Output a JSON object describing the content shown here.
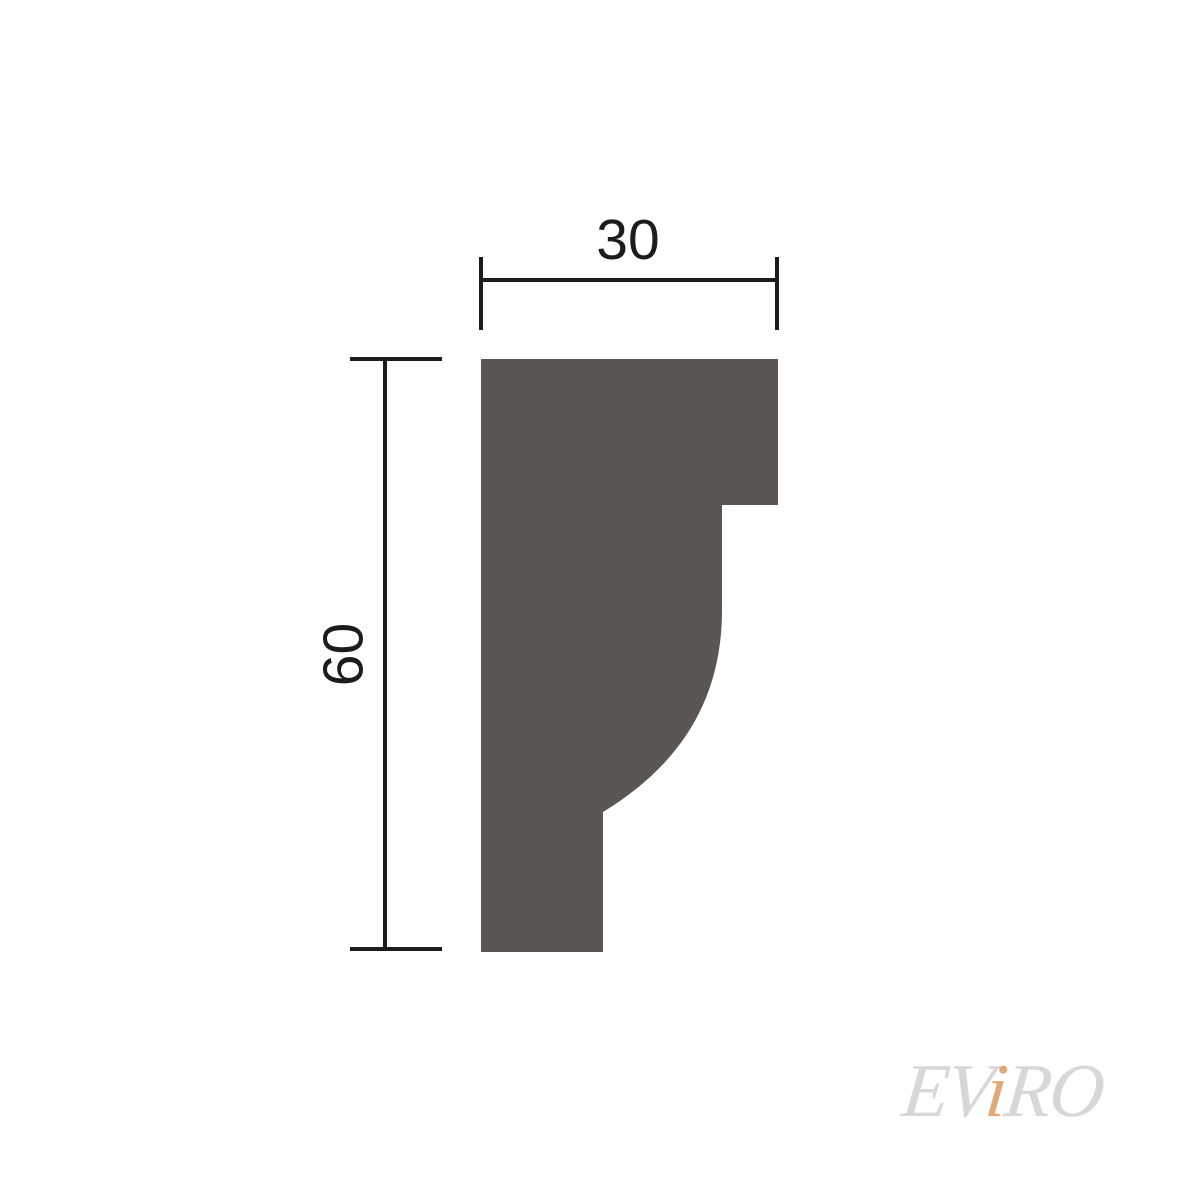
{
  "colors": {
    "background": "#ffffff",
    "profile_fill": "#5a5752",
    "dimension_line": "#1e1c1a",
    "watermark_text": "#d7d7d7",
    "watermark_accent": "#e3a878"
  },
  "dimensions": {
    "width_label": "30",
    "height_label": "60"
  },
  "watermark": {
    "part1": "EV",
    "accent": "i",
    "part2": "RO"
  }
}
